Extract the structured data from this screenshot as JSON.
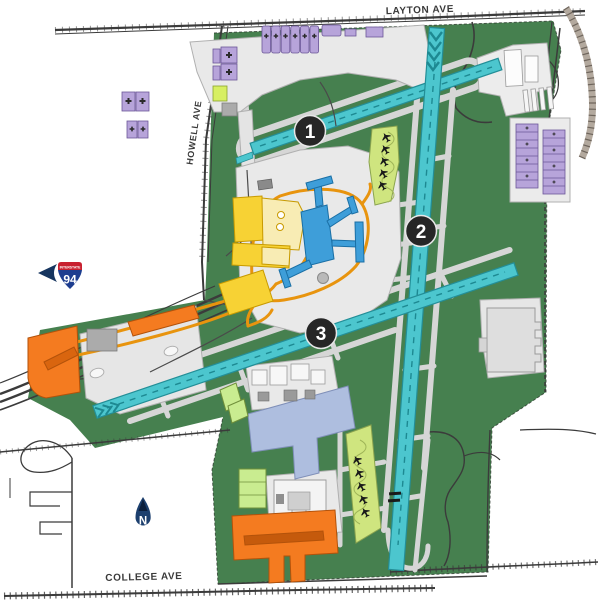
{
  "map_labels": {
    "layton_ave": "LAYTON AVE",
    "college_ave": "COLLEGE AVE",
    "howell_ave": "HOWELL AVE"
  },
  "interstate_shield": {
    "top_label": "INTERSTATE",
    "route_number": "94"
  },
  "compass": {
    "north_label": "N"
  },
  "runway_markers": [
    {
      "label": "1"
    },
    {
      "label": "2"
    },
    {
      "label": "3"
    }
  ],
  "legend_colors": {
    "grass": "#46804f",
    "runway": "#4cc6ce",
    "taxiway": "#d6d6d6",
    "apron": "#e9e9e9",
    "terminal_blue": "#3e9ed9",
    "parking_bright_yellow": "#f7d234",
    "parking_pale_yellow": "#f8ecb4",
    "terminal_access_roads": "#e8940e",
    "cargo_military_orange": "#f47b20",
    "hangars_purple": "#b7a4da",
    "buildings_green": "#c9ec90",
    "runup_pad_green": "#cfe57f",
    "south_apron_blue": "#aebedf",
    "marker_background": "#262626",
    "interstate_red": "#c8202f",
    "interstate_blue": "#1d3d8f"
  }
}
